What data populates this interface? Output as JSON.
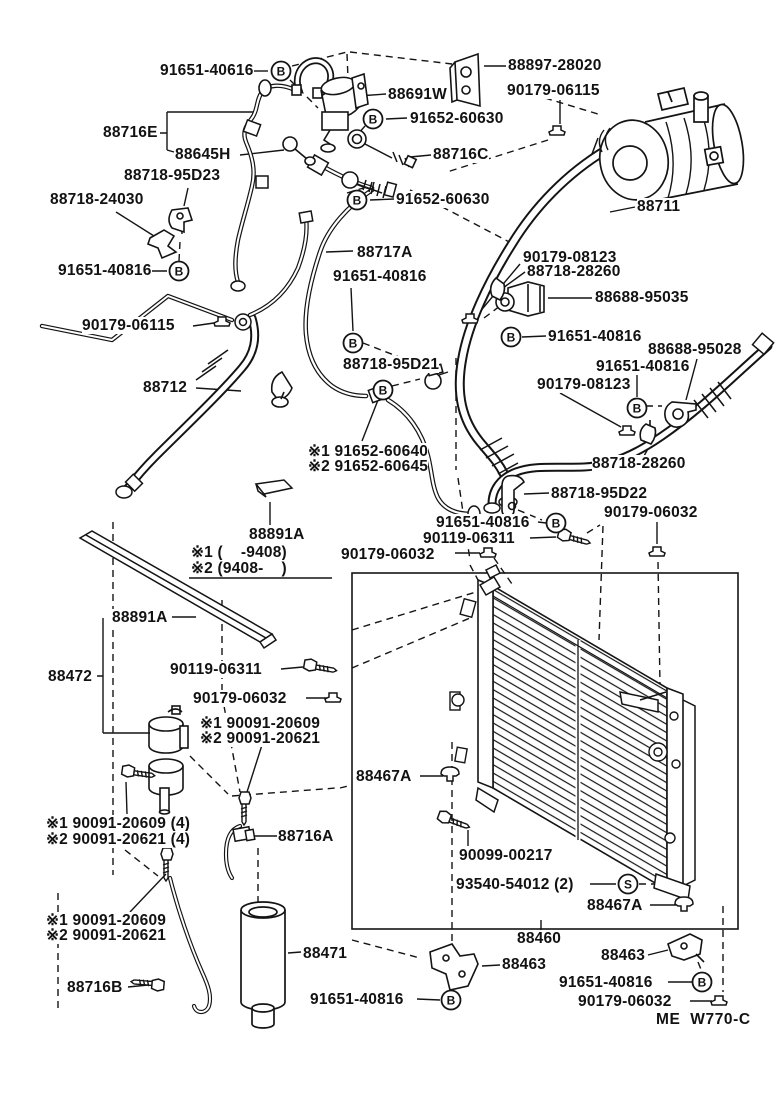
{
  "page": {
    "background": "#ffffff",
    "ink": "#141414"
  },
  "diagram": {
    "description": "air-conditioning-parts-exploded-diagram",
    "footer_code": "ME  W770-C",
    "labels": [
      {
        "text": "91651-40616",
        "x": 160,
        "y": 62
      },
      {
        "text": "88691W",
        "x": 388,
        "y": 86
      },
      {
        "text": "88897-28020",
        "x": 508,
        "y": 57
      },
      {
        "text": "90179-06115",
        "x": 507,
        "y": 82
      },
      {
        "text": "91652-60630",
        "x": 410,
        "y": 110
      },
      {
        "text": "88716E",
        "x": 103,
        "y": 124
      },
      {
        "text": "88645H",
        "x": 175,
        "y": 146
      },
      {
        "text": "88716C",
        "x": 433,
        "y": 146
      },
      {
        "text": "88718-95D23",
        "x": 124,
        "y": 167
      },
      {
        "text": "88718-24030",
        "x": 50,
        "y": 191
      },
      {
        "text": "91652-60630",
        "x": 396,
        "y": 191
      },
      {
        "text": "88711",
        "x": 637,
        "y": 198
      },
      {
        "text": "88717A",
        "x": 357,
        "y": 244
      },
      {
        "text": "90179-08123",
        "x": 523,
        "y": 249
      },
      {
        "text": "88718-28260",
        "x": 527,
        "y": 263
      },
      {
        "text": "91651-40816",
        "x": 58,
        "y": 262
      },
      {
        "text": "91651-40816",
        "x": 333,
        "y": 268
      },
      {
        "text": "88688-95035",
        "x": 595,
        "y": 289
      },
      {
        "text": "91651-40816",
        "x": 548,
        "y": 328
      },
      {
        "text": "90179-06115",
        "x": 82,
        "y": 317
      },
      {
        "text": "88688-95028",
        "x": 648,
        "y": 341
      },
      {
        "text": "91651-40816",
        "x": 596,
        "y": 358
      },
      {
        "text": "90179-08123",
        "x": 537,
        "y": 376
      },
      {
        "text": "88718-95D21",
        "x": 343,
        "y": 356
      },
      {
        "text": "88712",
        "x": 143,
        "y": 379
      },
      {
        "text": "※1 91652-60640",
        "x": 308,
        "y": 443
      },
      {
        "text": "※2 91652-60645",
        "x": 308,
        "y": 458
      },
      {
        "text": "88718-28260",
        "x": 592,
        "y": 455
      },
      {
        "text": "88718-95D22",
        "x": 551,
        "y": 485
      },
      {
        "text": "91651-40816",
        "x": 436,
        "y": 514
      },
      {
        "text": "90119-06311",
        "x": 423,
        "y": 530
      },
      {
        "text": "90179-06032",
        "x": 604,
        "y": 504
      },
      {
        "text": "90179-06032",
        "x": 341,
        "y": 546
      },
      {
        "text": "88891A",
        "x": 249,
        "y": 526
      },
      {
        "text": "※1 (    -9408)",
        "x": 191,
        "y": 544
      },
      {
        "text": "※2 (9408-    )",
        "x": 191,
        "y": 560
      },
      {
        "text": "88891A",
        "x": 112,
        "y": 609
      },
      {
        "text": "88472",
        "x": 48,
        "y": 668
      },
      {
        "text": "90119-06311",
        "x": 170,
        "y": 661
      },
      {
        "text": "90179-06032",
        "x": 193,
        "y": 690
      },
      {
        "text": "※1 90091-20609",
        "x": 200,
        "y": 715
      },
      {
        "text": "※2 90091-20621",
        "x": 200,
        "y": 730
      },
      {
        "text": "※1 90091-20609 (4)",
        "x": 46,
        "y": 815
      },
      {
        "text": "※2 90091-20621 (4)",
        "x": 46,
        "y": 831
      },
      {
        "text": "88716A",
        "x": 278,
        "y": 828
      },
      {
        "text": "88467A",
        "x": 356,
        "y": 768
      },
      {
        "text": "90099-00217",
        "x": 459,
        "y": 847
      },
      {
        "text": "93540-54012 (2)",
        "x": 456,
        "y": 876
      },
      {
        "text": "88467A",
        "x": 587,
        "y": 897
      },
      {
        "text": "88460",
        "x": 517,
        "y": 930
      },
      {
        "text": "88463",
        "x": 502,
        "y": 956
      },
      {
        "text": "88463",
        "x": 601,
        "y": 947
      },
      {
        "text": "※1 90091-20609",
        "x": 46,
        "y": 912
      },
      {
        "text": "※2 90091-20621",
        "x": 46,
        "y": 927
      },
      {
        "text": "88471",
        "x": 303,
        "y": 945
      },
      {
        "text": "88716B",
        "x": 67,
        "y": 979
      },
      {
        "text": "91651-40816",
        "x": 310,
        "y": 991
      },
      {
        "text": "91651-40816",
        "x": 559,
        "y": 974
      },
      {
        "text": "90179-06032",
        "x": 578,
        "y": 993
      }
    ],
    "markers": [
      {
        "letter": "B",
        "x": 281,
        "y": 71
      },
      {
        "letter": "B",
        "x": 373,
        "y": 119
      },
      {
        "letter": "B",
        "x": 357,
        "y": 200
      },
      {
        "letter": "B",
        "x": 179,
        "y": 271
      },
      {
        "letter": "B",
        "x": 353,
        "y": 343
      },
      {
        "letter": "B",
        "x": 511,
        "y": 337
      },
      {
        "letter": "B",
        "x": 383,
        "y": 390
      },
      {
        "letter": "B",
        "x": 637,
        "y": 408
      },
      {
        "letter": "B",
        "x": 556,
        "y": 523
      },
      {
        "letter": "B",
        "x": 451,
        "y": 1000
      },
      {
        "letter": "B",
        "x": 702,
        "y": 982
      },
      {
        "letter": "S",
        "x": 628,
        "y": 884
      }
    ]
  }
}
